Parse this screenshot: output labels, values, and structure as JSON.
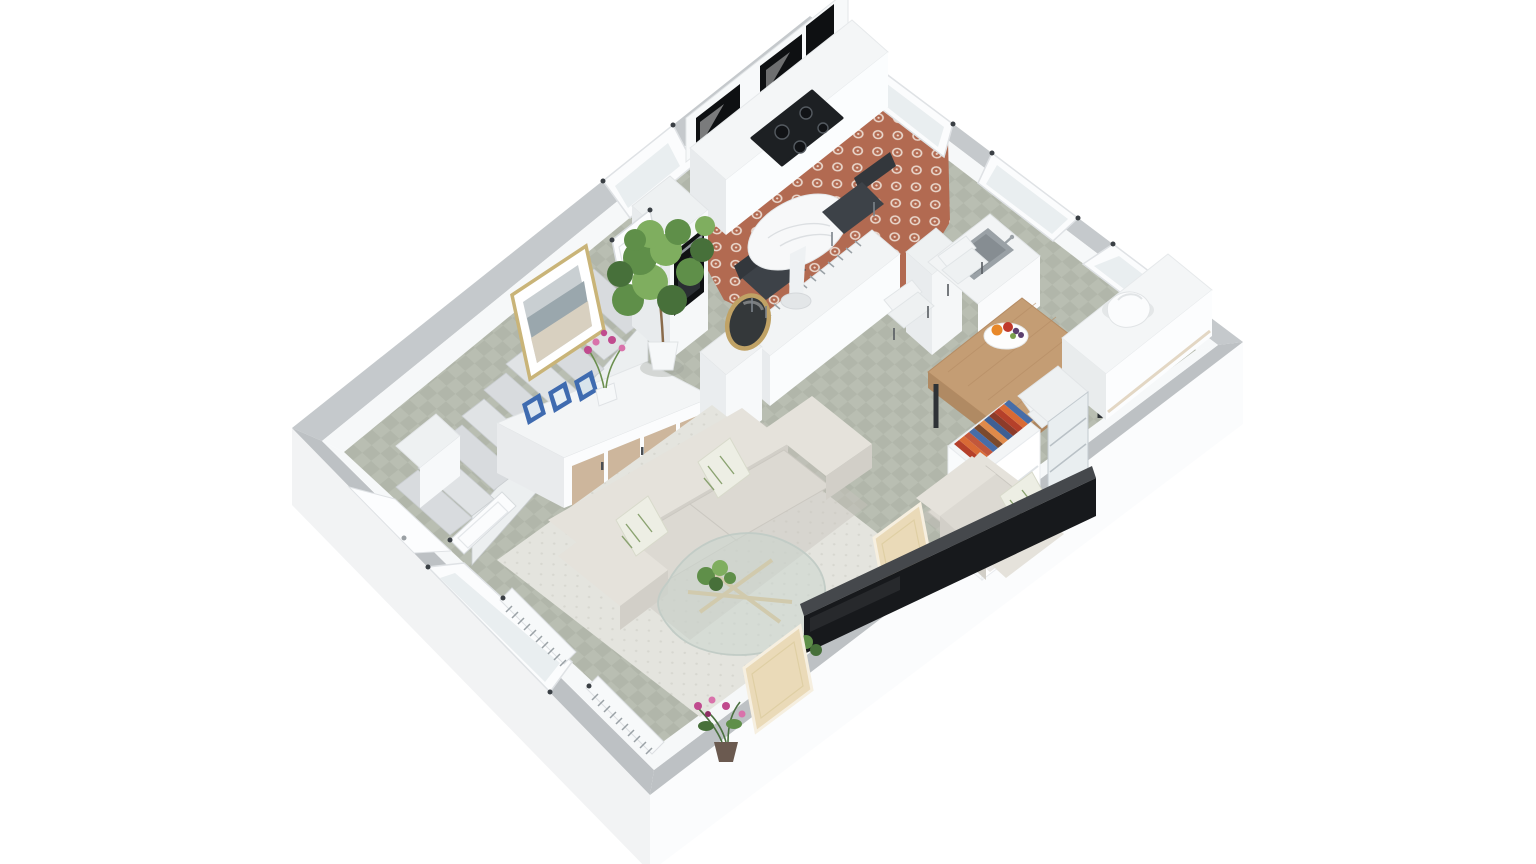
{
  "meta": {
    "description": "3D isometric cutaway render of an apartment ground-floor plan on a white background",
    "view": "axonometric top-down cutaway",
    "width": 1536,
    "height": 864
  },
  "palette": {
    "background": "#ffffff",
    "wall_top": "#c5c9cc",
    "wall_top_dark": "#bdc1c4",
    "wall_face": "#f6f8f9",
    "slab_sw": "#f2f3f4",
    "slab_se": "#fbfcfd",
    "floor_a": "#b9beb2",
    "floor_b": "#b1b6aa",
    "red_base": "#b26a51",
    "red_motif": "#ead8cd",
    "rug": "#e4e4de",
    "rug_dot": "#d7d7d0",
    "sofa": "#dcd9d2",
    "sofa_light": "#e5e2db",
    "sofa_dark": "#d2cfc8",
    "sofa_shadow": "#c7c4bd",
    "pillow": "#edeee4",
    "pillow_leaf": "#8ba371",
    "wood_door": "#cdb69c",
    "table_wood": "#c49d74",
    "table_edge": "#ad855e",
    "chair_dark": "#3d4248",
    "chair_dark2": "#33373c",
    "chair_white": "#f3f5f6",
    "tv": "#17191c",
    "tv_top": "#45484c",
    "canvas": "#eadab8",
    "mirror_frame": "#c0a265",
    "mirror_glass": "#34383a",
    "books": [
      "#b5402a",
      "#d96a35",
      "#c2573b",
      "#476da8",
      "#7b4a2d",
      "#e08a4a",
      "#3f5f93",
      "#8c3b2a"
    ],
    "plant": "#5f8f49",
    "plant_light": "#7fae5f",
    "plant_dark": "#47703a",
    "orchid": "#c04a8e",
    "orchid_light": "#d972ab",
    "fruit_orange": "#e8882a",
    "fruit_red": "#c0392b",
    "fruit_grape": "#5b3f6e",
    "fruit_green": "#7aa04c",
    "steel": "#aeb4b8",
    "basin": "#9aa1a6",
    "oven": "#0f1113",
    "cooktop": "#1d2023",
    "hood": "#2b2e32",
    "gloss_black": "#0e1012",
    "marble": "#f7f8f9",
    "stair": "#e0e3e5",
    "stair_b": "#d8dbde",
    "stair_side": "#eceff0",
    "frame_gold": "#c9b478",
    "art_sky": "#c9cfd2",
    "art_sea": "#9aa7ad",
    "art_sand": "#d8d0c0",
    "photo_blue": "#3f6bb0",
    "door_frame": "#dfe2e5",
    "glass": "#e9eef0",
    "radiator_fin": "#9aa1a6"
  },
  "scene": {
    "type": "3d-floor-plan",
    "style": "white cutaway walls, gray wall tops, furnished interior",
    "rooms": [
      {
        "name": "kitchen",
        "floor": "terracotta patterned cement tile",
        "items": [
          "white cabinet run with glossy black fronts",
          "black cooktop",
          "range hood",
          "tall cabinet with built-in oven",
          "round marble bistro table",
          "two dark gray chairs",
          "radiator on half wall",
          "window"
        ]
      },
      {
        "name": "utility-nook",
        "floor": "terracotta patterned cement tile",
        "items": [
          "sink counter with stainless basin",
          "partition wall",
          "window"
        ]
      },
      {
        "name": "dining-area",
        "floor": "sage checker tile",
        "items": [
          "rectangular wood dining table",
          "four white shell chairs",
          "fruit bowl",
          "white console under window",
          "white decorative sculpture",
          "open shelf with colorful books",
          "glass display cabinet"
        ]
      },
      {
        "name": "living-room",
        "floor": "sage checker tile",
        "items": [
          "area rug",
          "three-seat light gray sofa",
          "leaf-pattern throw pillows",
          "armchair with throw pillow",
          "organic glass coffee table",
          "potted plant",
          "wall-mounted TV",
          "two leaning beige canvases",
          "round brass mirror on partition",
          "radiators under window",
          "flowering plant in corner"
        ]
      },
      {
        "name": "entry-hall",
        "floor": "sage checker tile",
        "items": [
          "front door",
          "open interior door",
          "partition walls"
        ]
      },
      {
        "name": "stair-area",
        "items": [
          "staircase",
          "leaning framed seascape artwork",
          "sideboard with travertine doors",
          "three blue photo frames",
          "white vase with pink orchid",
          "fiddle-leaf fig in white pot"
        ]
      }
    ]
  }
}
